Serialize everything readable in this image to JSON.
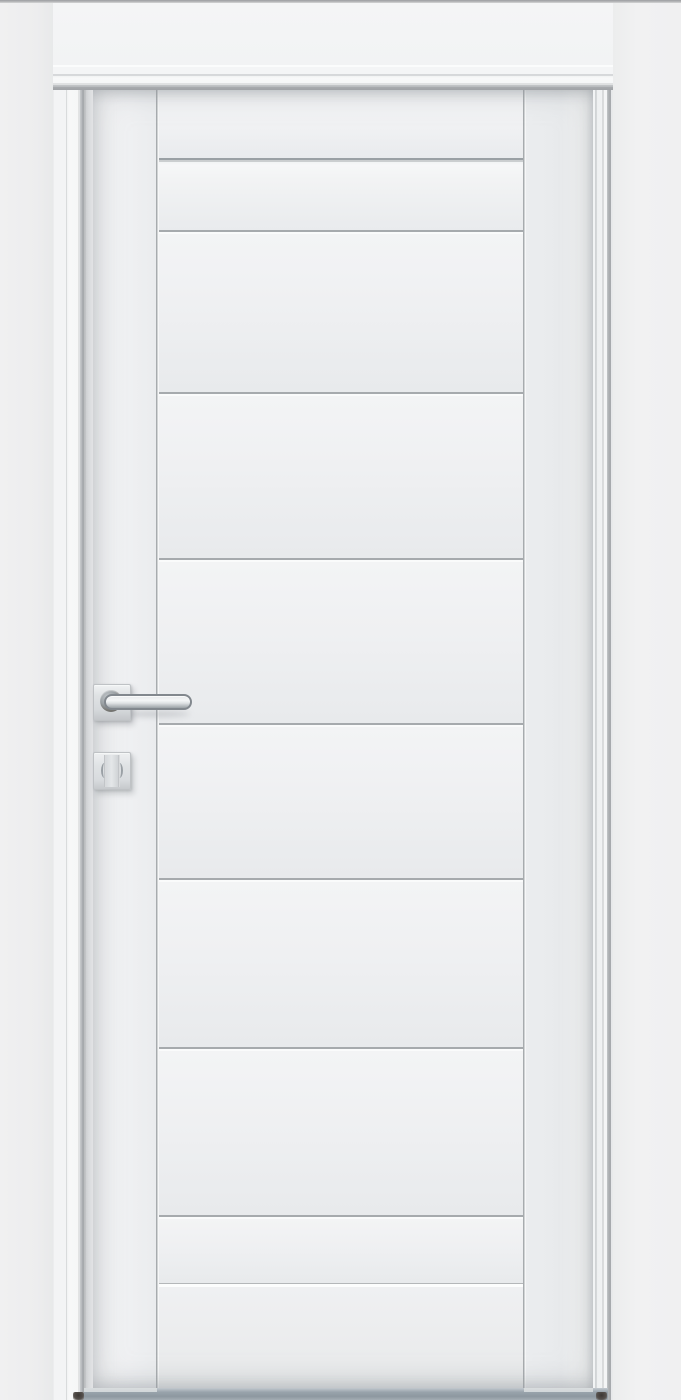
{
  "meta": {
    "subject": "Closed white interior door, frontal product view",
    "wall": "white wall with white architrave casing",
    "floor": "gray floor gap visible under the door leaf"
  },
  "door": {
    "leaf_label": "White door leaf with grooved horizontal panels",
    "panel_band_count": 8,
    "groove_positions_y": [
      158,
      230,
      392,
      558,
      723,
      878,
      1047,
      1215
    ],
    "bottom_ridge_y": 1283,
    "stile_grooves_x": [
      157,
      524
    ],
    "leaf_top_y": 90,
    "leaf_bottom_y": 1388
  },
  "hardware": {
    "lever_handle_label": "Satin chrome lever handle on square rosette",
    "privacy_turn_label": "Square privacy-turn escutcheon below handle"
  },
  "colors": {
    "wall_left": "#ededee",
    "wall_right": "#f1f1f2",
    "wall_header": "#f3f4f5",
    "casing": "#f4f5f6",
    "casing_inner_shadow": "#a8abae",
    "leaf": "#eff0f1",
    "groove_dark": "#a6aaad",
    "groove_highlight": "#fafbfb",
    "hardware_metal": "#dcdfe2",
    "hardware_boss_dark": "#6e6f6c",
    "floor_gap": "#95a0a8",
    "foot_shadow": "#3c3734",
    "ceiling_line": "#9b9da0"
  }
}
